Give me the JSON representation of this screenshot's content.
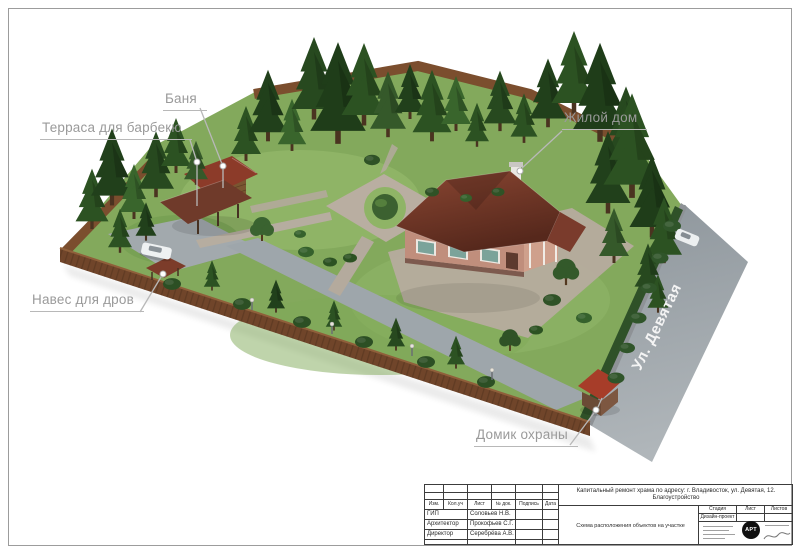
{
  "colors": {
    "lawn": "#83a95c",
    "lawn_light": "#9dc274",
    "road": "#a0a7ac",
    "path": "#b7ab9e",
    "fence": "#70452a",
    "roof_main": "#6e3427",
    "wall": "#c08e7c",
    "tree_mid": "#2c5222",
    "label_text": "#9a9a9a",
    "leader_line": "#b8b8b8",
    "street_text": "#f4f4f4",
    "stamp_line": "#3c3c3c"
  },
  "annotations": {
    "bathhouse": "Баня",
    "bbq_terrace": "Терраса для барбекю",
    "residential_house": "Жилой дом",
    "firewood_shed": "Навес для дров",
    "guard_house": "Домик охраны"
  },
  "street": {
    "name": "Ул. Девятая"
  },
  "title_block": {
    "revision_header": [
      "Изм.",
      "Кол.уч",
      "Лист",
      "№ док.",
      "Подпись",
      "Дата"
    ],
    "signatures": [
      {
        "role": "ГИП",
        "name": "Соловьев Н.В."
      },
      {
        "role": "Архитектор",
        "name": "Прокофьев С.Г."
      },
      {
        "role": "Директор",
        "name": "Серебрёва А.В."
      }
    ],
    "project_title_line1": "Капитальный ремонт храма по адресу: г. Владивосток, ул. Девятая, 12.",
    "project_title_line2": "Благоустройство",
    "sheet_title": "Схема расположения объектов на участке",
    "stage_header": [
      "Стадия",
      "Лист",
      "Листов"
    ],
    "stage_value": "Дизайн-проект",
    "logo_text": "АРТ"
  }
}
